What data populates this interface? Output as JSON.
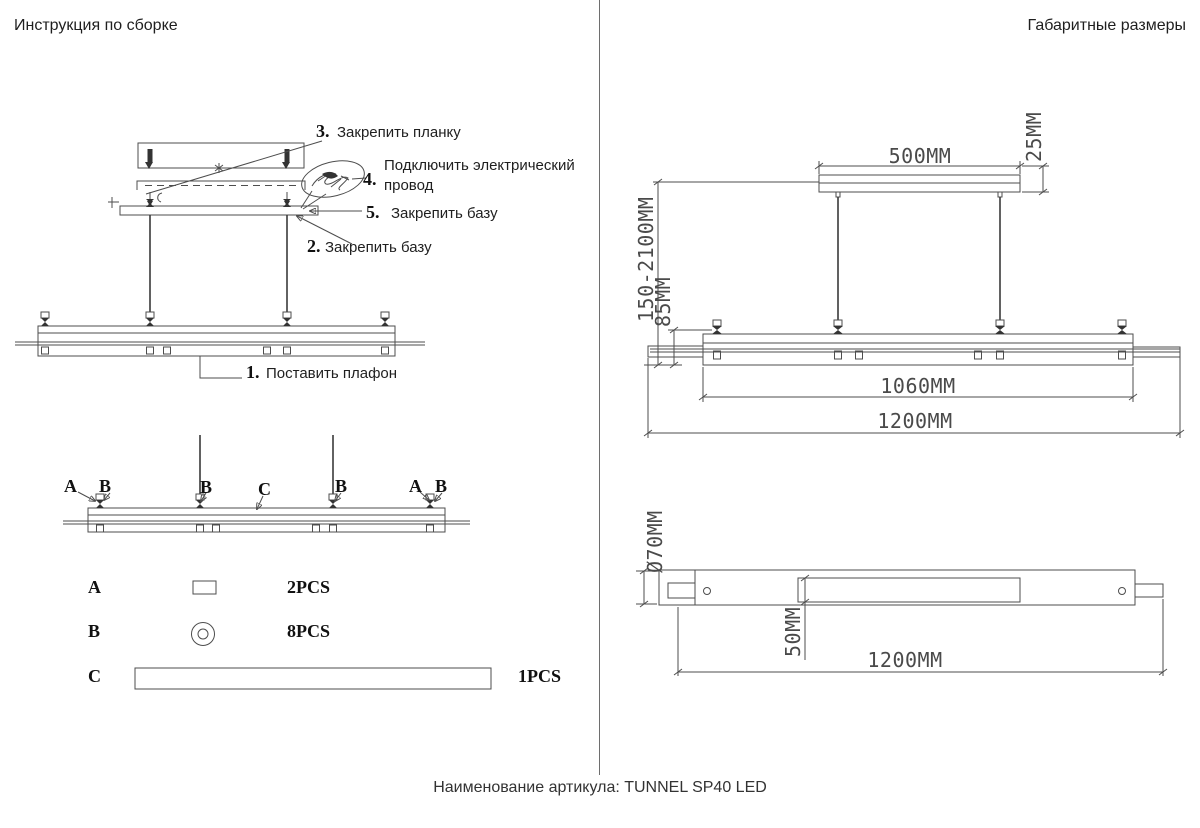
{
  "colors": {
    "background": "#ffffff",
    "line": "#4d4d4d",
    "text": "#1f1f1f",
    "dim_text": "#4a4a4a"
  },
  "left_panel": {
    "title": "Инструкция по сборке",
    "steps": {
      "s3": {
        "num": "3.",
        "text": "Закрепить планку"
      },
      "s4": {
        "num": "4.",
        "text": "Подключить электрический провод"
      },
      "s5": {
        "num": "5.",
        "text": "Закрепить базу"
      },
      "s2": {
        "num": "2.",
        "text": "Закрепить базу"
      },
      "s1": {
        "num": "1.",
        "text": "Поставить плафон"
      }
    },
    "callout_labels": {
      "a1": "A",
      "b1": "B",
      "b2": "B",
      "c": "C",
      "b3": "B",
      "a2": "A",
      "b4": "B"
    },
    "parts": {
      "a": {
        "letter": "A",
        "qty": "2PCS",
        "icon": "rectangle-bracket-part-icon"
      },
      "b": {
        "letter": "B",
        "qty": "8PCS",
        "icon": "washer-part-icon"
      },
      "c": {
        "letter": "C",
        "qty": "1PCS",
        "icon": "long-bar-part-icon"
      }
    }
  },
  "right_panel": {
    "title": "Габаритные размеры",
    "dims": {
      "canopy_width": "500MM",
      "canopy_height": "25MM",
      "suspension": "150-2100MM",
      "hanger": "85MM",
      "body_length": "1060MM",
      "overall_length": "1200MM",
      "diameter": "Ø70MM",
      "profile_height": "50MM",
      "bottom_length": "1200MM"
    }
  },
  "footer": "Наименование артикула: TUNNEL SP40 LED"
}
